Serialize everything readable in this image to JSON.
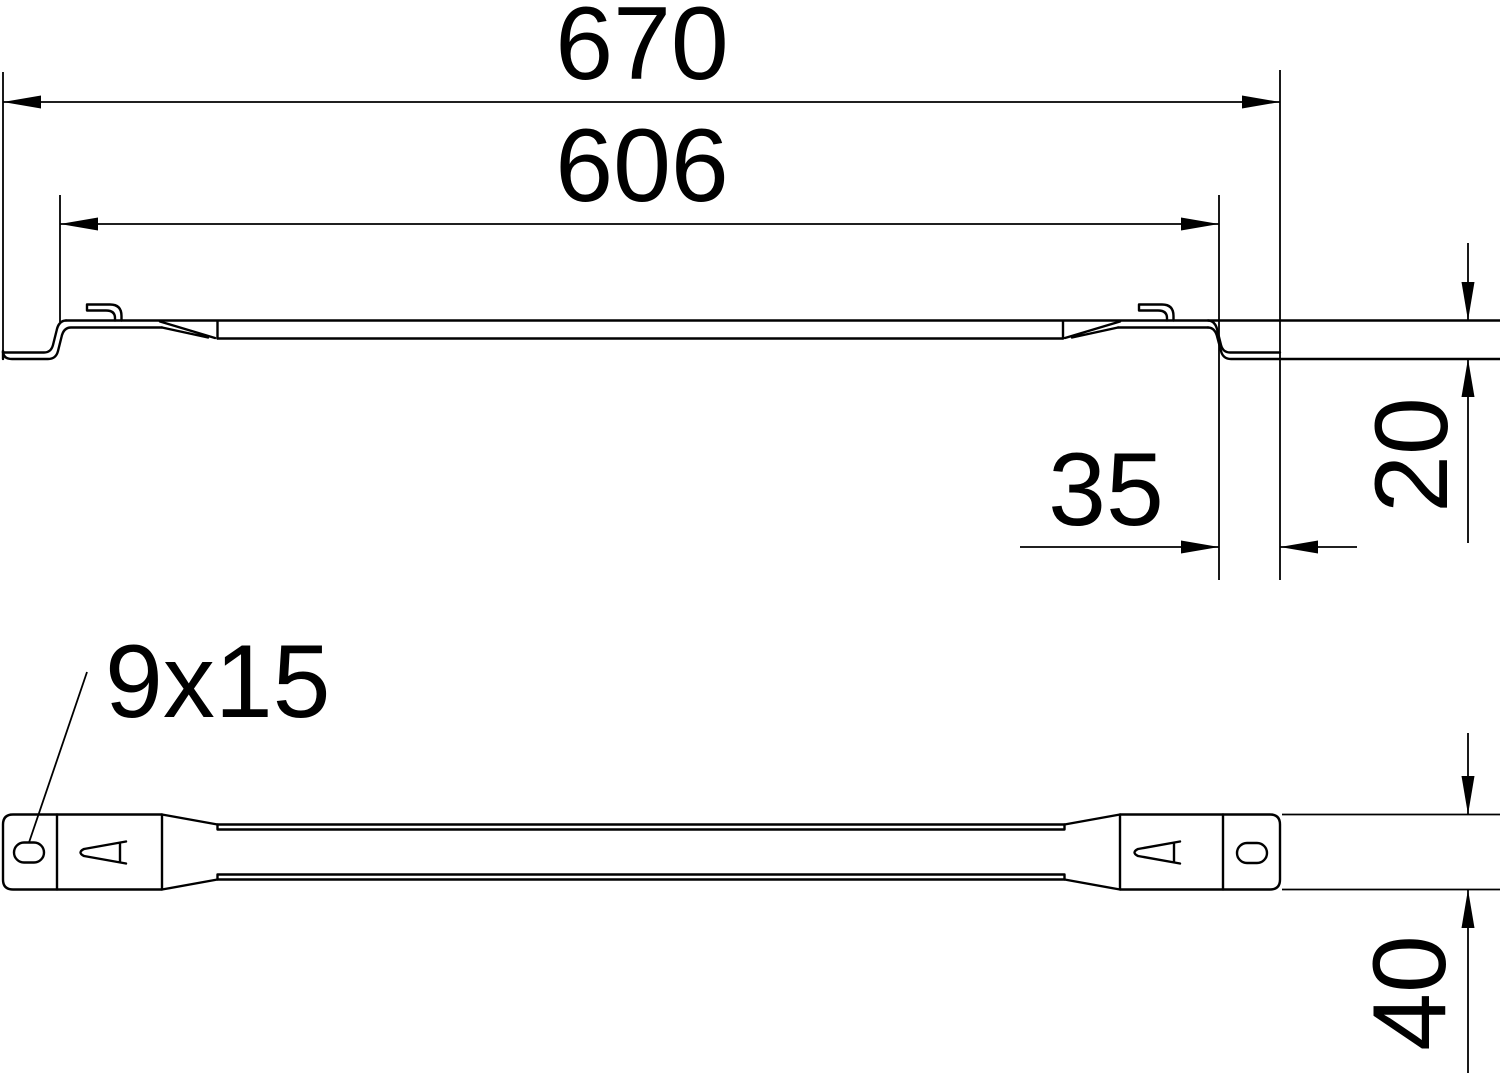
{
  "title": "Distance rail technical drawing",
  "line_color": "#000000",
  "background_color": "#ffffff",
  "views": {
    "side_view_name": "side-profile-view",
    "plan_view_name": "plan-view"
  },
  "dimensions": {
    "overall_length": "670",
    "inner_length": "606",
    "end_offset": "35",
    "height_offset": "20",
    "rail_width": "40",
    "slot_size_label": "9x15"
  }
}
